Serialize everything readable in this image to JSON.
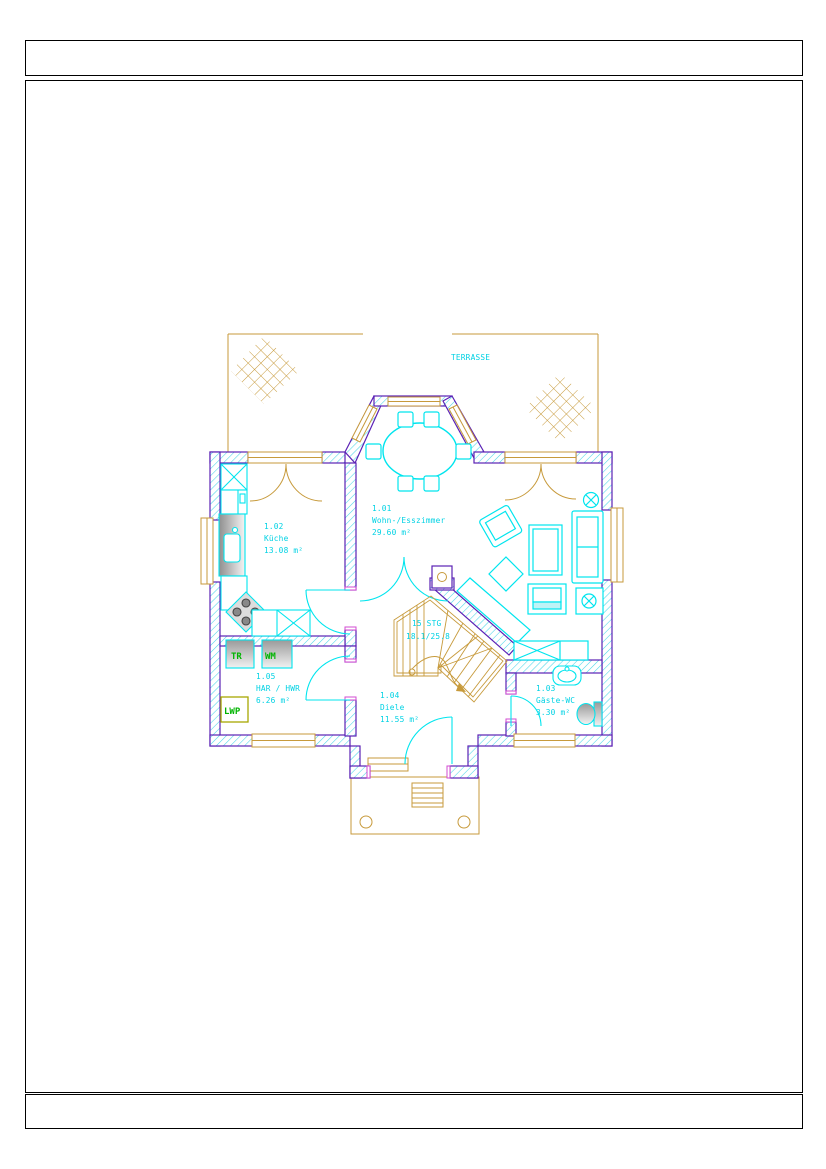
{
  "floor_plan": {
    "terrace": {
      "label": "TERRASSE"
    },
    "rooms": [
      {
        "number": "1.01",
        "name": "Wohn-/Esszimmer",
        "area": "29.60 m²"
      },
      {
        "number": "1.02",
        "name": "Küche",
        "area": "13.08 m²"
      },
      {
        "number": "1.03",
        "name": "Gäste-WC",
        "area": "3.30 m²"
      },
      {
        "number": "1.04",
        "name": "Diele",
        "area": "11.55 m²"
      },
      {
        "number": "1.05",
        "name": "HAR / HWR",
        "area": "6.26 m²"
      }
    ],
    "stair": {
      "count_label": "15 STG",
      "ratio_label": "18.1/25.8"
    },
    "appliances": [
      {
        "label": "TR"
      },
      {
        "label": "WM"
      },
      {
        "label": "LWP"
      }
    ],
    "colors": {
      "furniture_cyan": "#00e5ee",
      "label_cyan": "#00d2e4",
      "wood_tan": "#c79a3b",
      "wall_outline_purple": "#5b21b5",
      "wall_hatch_cyan": "#49d6e8",
      "jamb_magenta": "#d24bd2",
      "appliance_green": "#00b400",
      "lwp_border_olive": "#a8a800"
    }
  }
}
